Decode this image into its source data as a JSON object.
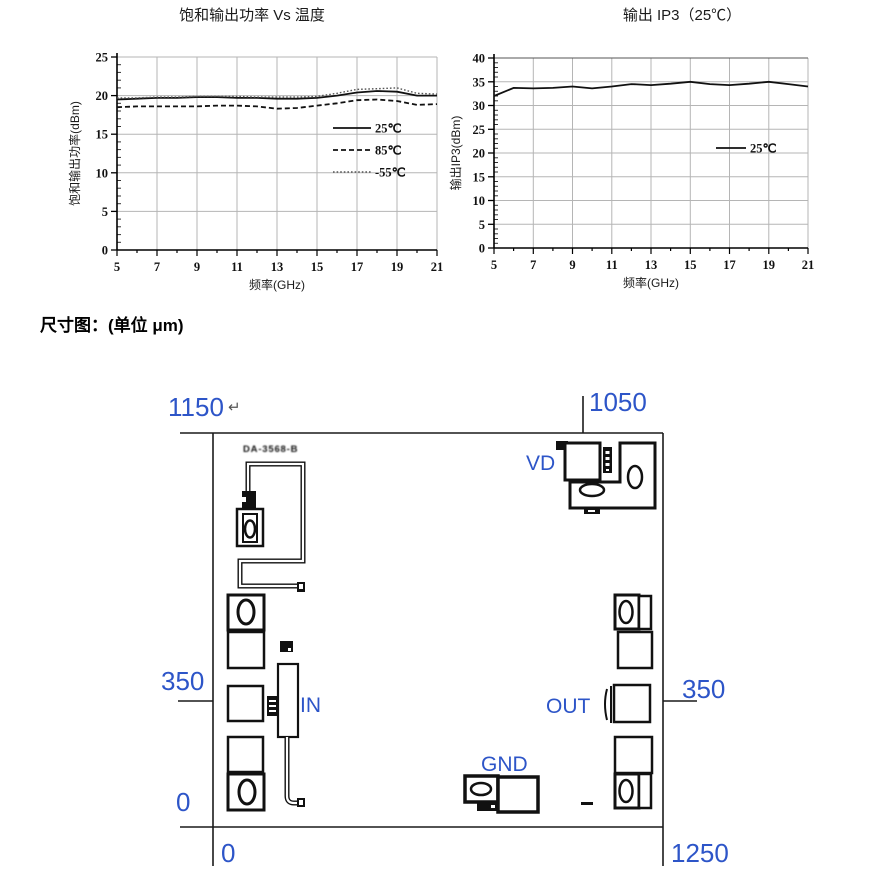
{
  "section": {
    "title": "尺寸图：(单位 μm)"
  },
  "chart_data": [
    {
      "type": "line",
      "title": "饱和输出功率 Vs 温度",
      "xlabel": "频率(GHz)",
      "ylabel": "饱和输出功率(dBm)",
      "xlim": [
        5,
        21
      ],
      "ylim": [
        0,
        25
      ],
      "xticks": [
        5,
        7,
        9,
        11,
        13,
        15,
        17,
        19,
        21
      ],
      "ytick_step": 5,
      "grid": true,
      "legend_position": "inside-right",
      "x": [
        5,
        6,
        7,
        8,
        9,
        10,
        11,
        12,
        13,
        14,
        15,
        16,
        17,
        18,
        19,
        20,
        21
      ],
      "series": [
        {
          "name": "25℃",
          "style": "solid",
          "values": [
            19.5,
            19.6,
            19.7,
            19.7,
            19.8,
            19.8,
            19.7,
            19.7,
            19.6,
            19.6,
            19.7,
            20.0,
            20.4,
            20.6,
            20.5,
            20.0,
            20.0
          ]
        },
        {
          "name": "85℃",
          "style": "dashed",
          "values": [
            18.5,
            18.6,
            18.6,
            18.6,
            18.6,
            18.7,
            18.7,
            18.6,
            18.3,
            18.4,
            18.7,
            19.0,
            19.4,
            19.5,
            19.3,
            18.8,
            18.9
          ]
        },
        {
          "name": "-55℃",
          "style": "dotted",
          "values": [
            19.7,
            19.7,
            19.8,
            19.8,
            19.9,
            19.9,
            19.9,
            19.8,
            19.8,
            19.8,
            19.9,
            20.3,
            20.8,
            20.9,
            21.0,
            20.3,
            20.2
          ]
        }
      ]
    },
    {
      "type": "line",
      "title": "输出 IP3（25℃）",
      "xlabel": "频率(GHz)",
      "ylabel": "输出IP3(dBm)",
      "xlim": [
        5,
        21
      ],
      "ylim": [
        0,
        40
      ],
      "xticks": [
        5,
        7,
        9,
        11,
        13,
        15,
        17,
        19,
        21
      ],
      "ytick_step": 5,
      "grid": true,
      "legend_position": "inside-right",
      "x": [
        5,
        6,
        7,
        8,
        9,
        10,
        11,
        12,
        13,
        14,
        15,
        16,
        17,
        18,
        19,
        20,
        21
      ],
      "series": [
        {
          "name": "25℃",
          "style": "solid",
          "values": [
            32.0,
            33.7,
            33.6,
            33.7,
            34.0,
            33.6,
            34.0,
            34.5,
            34.3,
            34.6,
            35.0,
            34.5,
            34.3,
            34.6,
            35.0,
            34.5,
            34.0
          ]
        }
      ]
    }
  ],
  "diagram": {
    "unit": "μm",
    "labels": {
      "top_width": "1150",
      "paragraph_mark": "↵",
      "top_right_height": "1050",
      "left_height": "350",
      "right_height": "350",
      "left_zero": "0",
      "bottom_zero": "0",
      "bottom_width": "1250",
      "port_vd": "VD",
      "port_in": "IN",
      "port_out": "OUT",
      "port_gnd": "GND",
      "part_marking": "DA-3568-B"
    },
    "accent_blue": "#2d55c8"
  }
}
